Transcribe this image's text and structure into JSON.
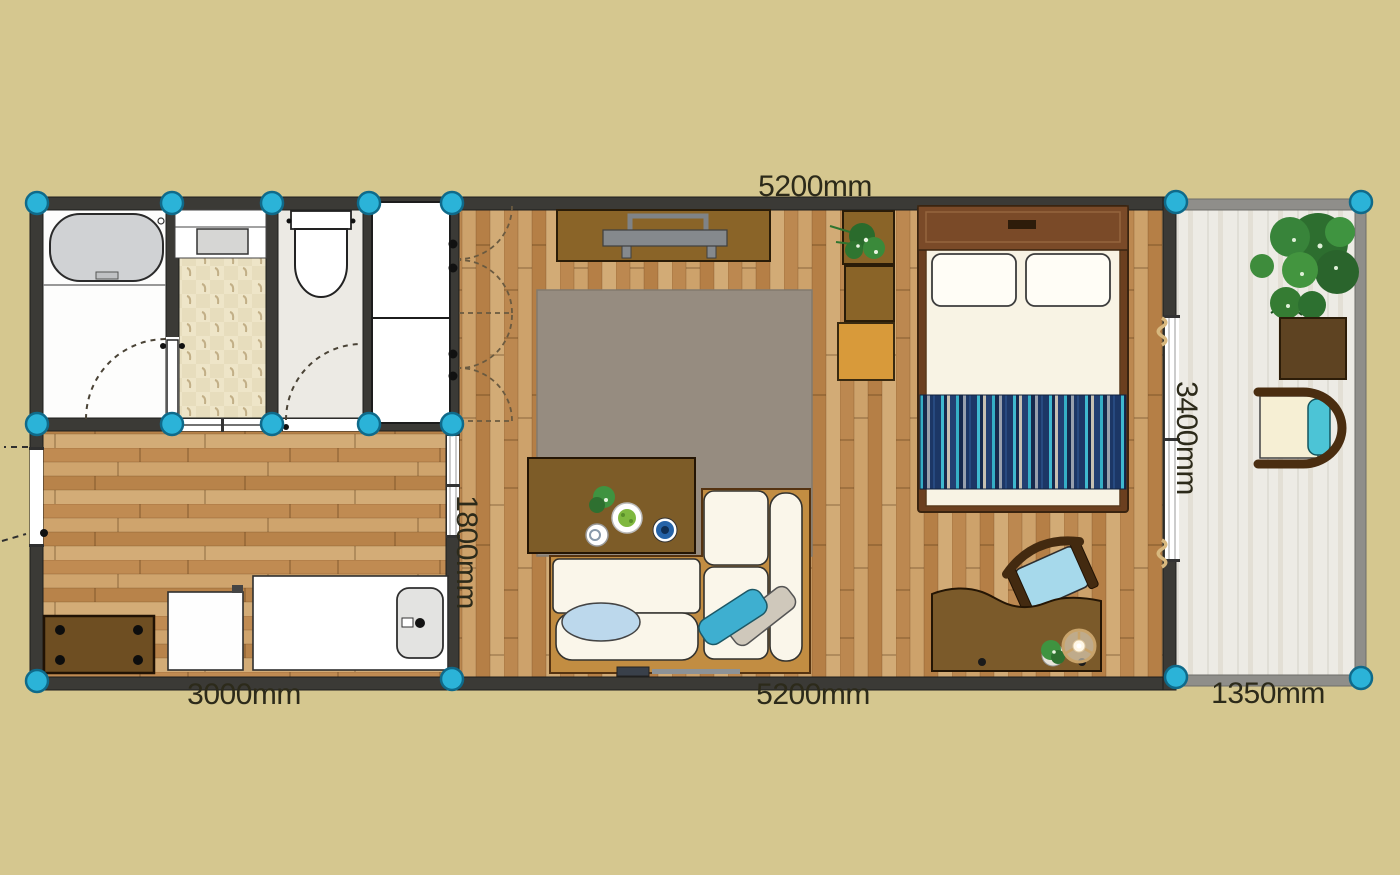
{
  "canvas": {
    "width": 1400,
    "height": 875,
    "background": "#d5c78f"
  },
  "dimensions": {
    "top_width": "5200mm",
    "bottom_left_width": "3000mm",
    "bottom_middle_width": "5200mm",
    "bottom_right_width": "1350mm",
    "left_room_depth": "1800mm",
    "right_room_depth": "3400mm"
  },
  "colors": {
    "background": "#d5c78f",
    "wall": "#3b3a36",
    "balcony_wall": "#8f8e8a",
    "wood_floor": "#c49760",
    "handle_accent": "#2bb3d8",
    "label_text": "#2c2a1a",
    "rug": "#968c80",
    "bed_runner_navy": "#1c3766",
    "bed_runner_teal": "#3fb9cf",
    "furniture_brown": "#7b5a2a",
    "storage_orange": "#d89a3a"
  },
  "furniture": [
    "bathtub",
    "vanity-sink",
    "toilet",
    "storage-closet",
    "tv-stand",
    "tv",
    "wall-shelf-boxes",
    "storage-box",
    "area-rug",
    "coffee-table",
    "sofa",
    "sofa-cushions",
    "double-bed",
    "bed-pillows",
    "bed-runner-rug",
    "work-desk",
    "desk-chair",
    "desk-lamp",
    "dining-table",
    "appliance",
    "kitchen-counter",
    "kitchen-sink",
    "balcony-plant",
    "balcony-table",
    "balcony-chair",
    "potted-plants"
  ]
}
